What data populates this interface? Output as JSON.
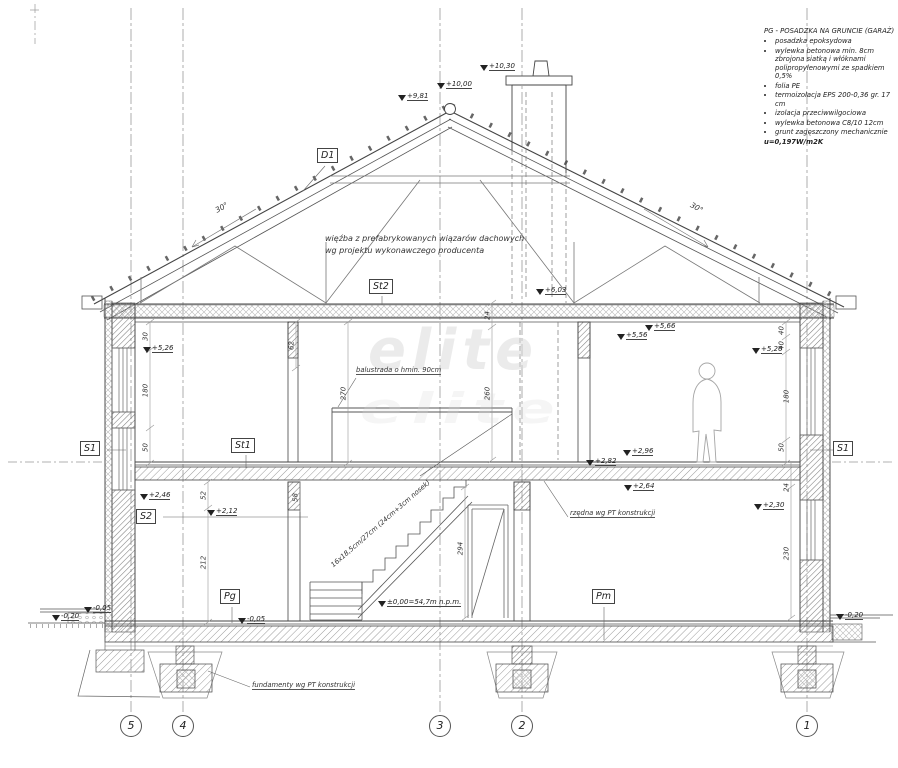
{
  "legend": {
    "title": "PG - POSADZKA NA GRUNCIE (GARAŻ)",
    "items": [
      "posadzka epoksydowa",
      "wylewka betonowa min. 8cm zbrojona siatką i włóknami polipropylenowymi ze spadkiem 0,5%",
      "folia PE",
      "termoizolacja EPS 200-0,36 gr. 17 cm",
      "izolacja przeciwwilgociowa",
      "wylewka betonowa C8/10 12cm",
      "grunt zagęszczony mechanicznie"
    ],
    "u_value": "u=0,197W/m2K"
  },
  "notes": {
    "truss_line1": "więźba z prefabrykowanych wiązarów dachowych",
    "truss_line2": "wg projektu wykonawczego producenta",
    "balustrade": "balustrada o hmin. 90cm",
    "stairs": "16x18,5cm/27cm (24cm+3cm nosek)",
    "slab": "rzędna wg PT konstrukcji",
    "foundation": "fundamenty wg PT konstrukcji"
  },
  "labels": {
    "d1": "D1",
    "st2": "St2",
    "st1": "St1",
    "s1_left": "S1",
    "s1_right": "S1",
    "s2": "S2",
    "pg": "Pg",
    "pm": "Pm"
  },
  "elevations": [
    "+10,30",
    "+10,00",
    "+9,81",
    "+6,03",
    "+5,66",
    "+5,56",
    "+5,26",
    "+5,26",
    "+2,96",
    "+2,82",
    "+2,64",
    "+2,46",
    "+2,12",
    "+2,30",
    "-0,05",
    "-0,20",
    "-0,05",
    "-0,20"
  ],
  "datum": "±0,00=54,7m n.p.m.",
  "dimensions": [
    "30",
    "180",
    "50",
    "62",
    "270",
    "24",
    "260",
    "294",
    "52",
    "58",
    "212",
    "40",
    "40",
    "180",
    "50",
    "24",
    "230"
  ],
  "slopes": {
    "left": "30°",
    "right": "30°"
  },
  "grid_bubbles": [
    "5",
    "4",
    "3",
    "2",
    "1"
  ],
  "watermark": "elite"
}
